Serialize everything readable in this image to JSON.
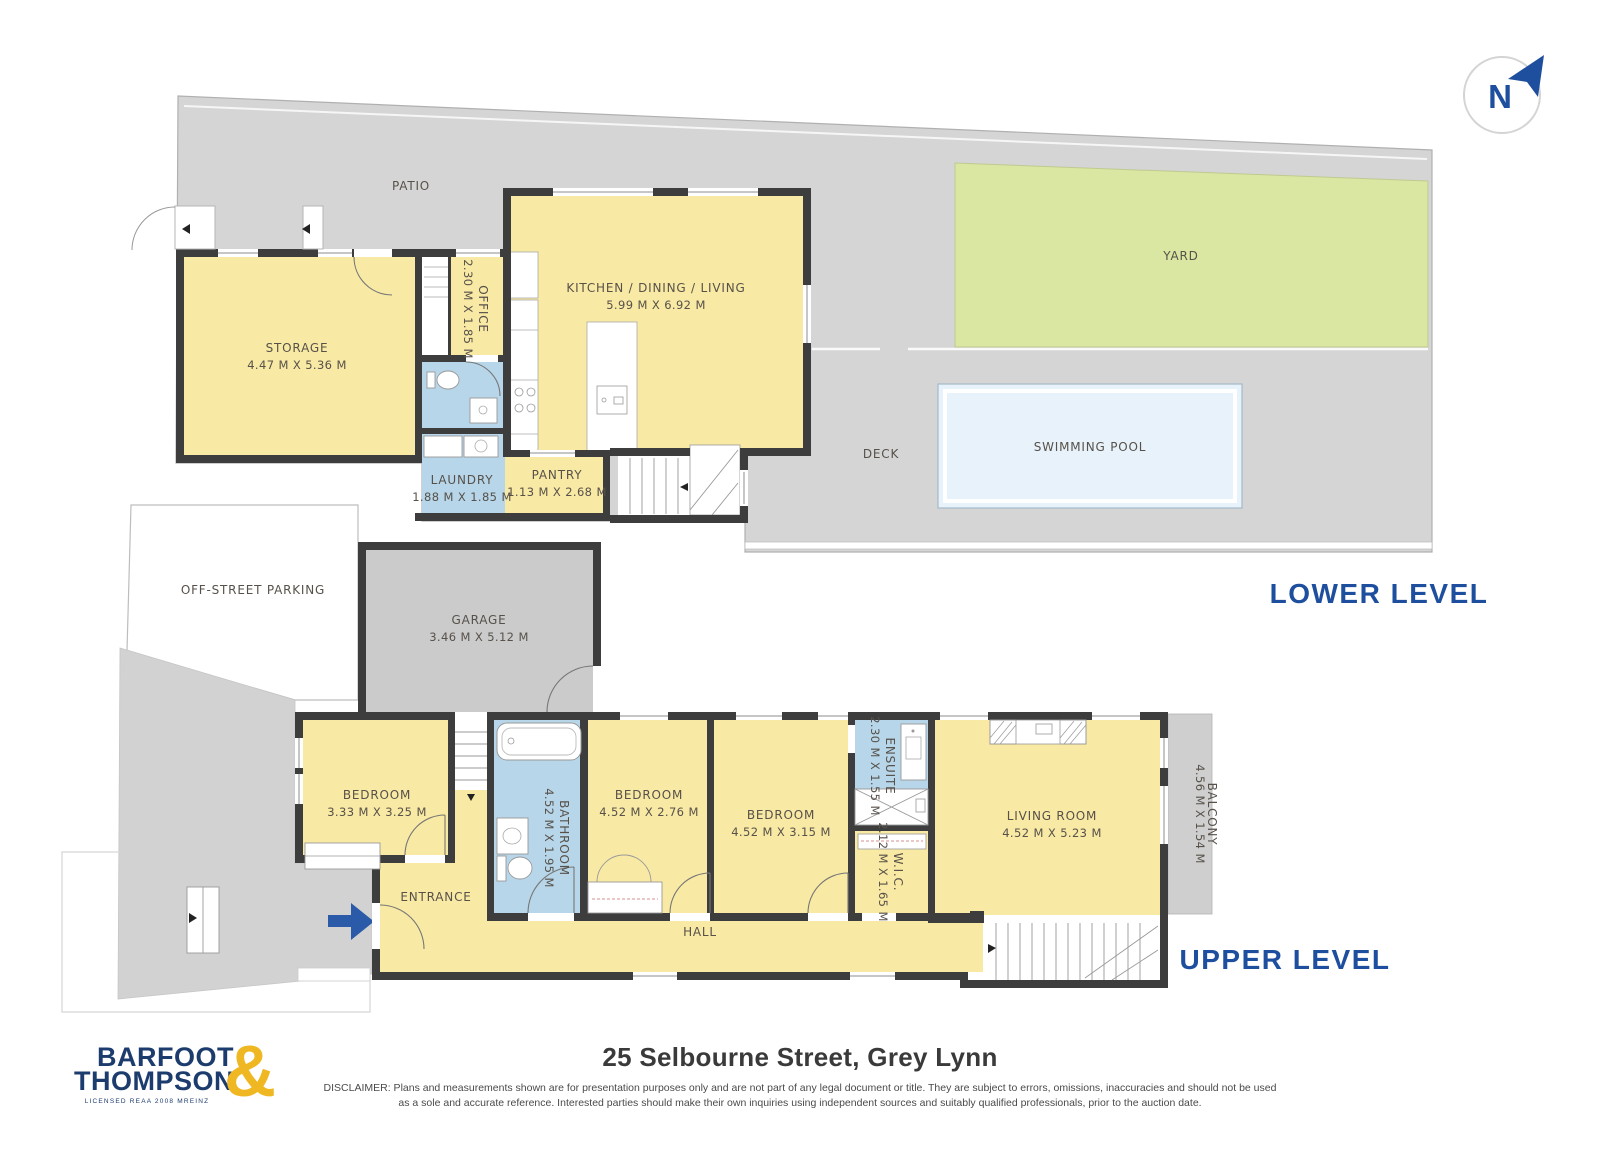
{
  "page": {
    "address": "25 Selbourne Street, Grey Lynn",
    "disclaimer_line1": "DISCLAIMER: Plans and measurements shown are for presentation purposes only and are not part of any legal document or title. They are subject to errors, omissions, inaccuracies and should not be used",
    "disclaimer_line2": "as a sole and accurate reference. Interested parties should make their own inquiries using independent sources and suitably qualified professionals, prior to the auction date."
  },
  "branding": {
    "logo_line1": "BARFOOT",
    "logo_line2": "THOMPSON",
    "logo_ampersand": "&",
    "logo_tagline": "LICENSED REAA 2008 MREINZ"
  },
  "compass": {
    "north_label": "N"
  },
  "levels": {
    "lower": {
      "label": "LOWER LEVEL"
    },
    "upper": {
      "label": "UPPER LEVEL"
    }
  },
  "lower_level": {
    "patio": {
      "name": "PATIO"
    },
    "storage": {
      "name": "STORAGE",
      "dims": "4.47 M X 5.36 M"
    },
    "office": {
      "name": "OFFICE",
      "dims": "2.30 M X 1.85 M"
    },
    "kitchen_dining_living": {
      "name": "KITCHEN / DINING / LIVING",
      "dims": "5.99 M X 6.92 M"
    },
    "laundry": {
      "name": "LAUNDRY",
      "dims": "1.88 M X 1.85 M"
    },
    "pantry": {
      "name": "PANTRY",
      "dims": "1.13 M X 2.68 M"
    },
    "yard": {
      "name": "YARD"
    },
    "deck": {
      "name": "DECK"
    },
    "swimming_pool": {
      "name": "SWIMMING POOL"
    }
  },
  "upper_level": {
    "off_street_parking": {
      "name": "OFF-STREET PARKING"
    },
    "garage": {
      "name": "GARAGE",
      "dims": "3.46 M X 5.12 M"
    },
    "bedroom_1": {
      "name": "BEDROOM",
      "dims": "3.33 M X 3.25 M"
    },
    "bathroom": {
      "name": "BATHROOM",
      "dims": "4.52 M X 1.95 M"
    },
    "bedroom_2": {
      "name": "BEDROOM",
      "dims": "4.52 M X 2.76 M"
    },
    "bedroom_3": {
      "name": "BEDROOM",
      "dims": "4.52 M X 3.15 M"
    },
    "ensuite": {
      "name": "ENSUITE",
      "dims": "2.30 M X 1.55 M"
    },
    "wic": {
      "name": "W.I.C.",
      "dims": "2.12 M X 1.65 M"
    },
    "living_room": {
      "name": "LIVING ROOM",
      "dims": "4.52 M X 5.23 M"
    },
    "balcony": {
      "name": "BALCONY",
      "dims": "4.56 M X 1.54 M"
    },
    "entrance": {
      "name": "ENTRANCE"
    },
    "hall": {
      "name": "HALL"
    }
  },
  "colors": {
    "room_fill": "#F8E9A4",
    "wet_room_fill": "#B7D6E9",
    "hard_surface_fill": "#D5D5D5",
    "garage_fill": "#CBCBCB",
    "yard_fill": "#DAE7A2",
    "pool_fill": "#E7F2FB",
    "wall": "#3D3D3D",
    "accent_navy": "#1E4F9E",
    "logo_navy": "#1D3C6E",
    "logo_gold": "#EFB722",
    "entrance_arrow_blue": "#2B5AA9",
    "label_text": "#57514A"
  }
}
